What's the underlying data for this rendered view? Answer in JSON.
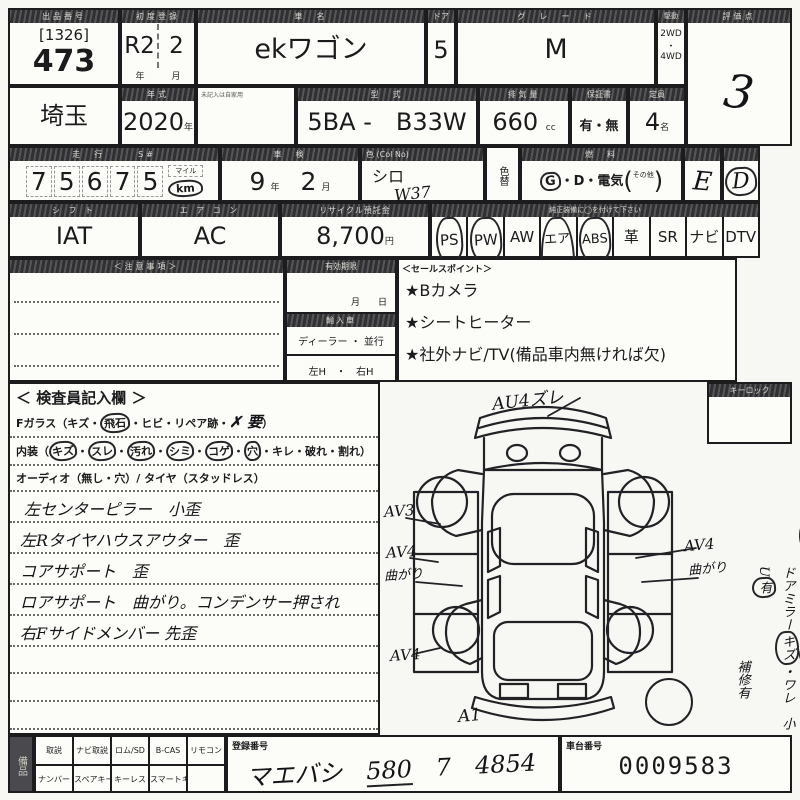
{
  "colors": {
    "paper": "#f7f7f3",
    "ink": "#1c1c1e",
    "band": "#3a3a3e"
  },
  "row1": {
    "lot_label": "出品番号",
    "lot_code": "[1326]",
    "lot_number": "473",
    "firstreg_label": "初度登録",
    "firstreg_year": "R2",
    "firstreg_month": "2",
    "unit_year": "年",
    "unit_month": "月",
    "name_label": "車　名",
    "car_name": "ekワゴン",
    "door_label": "ドア",
    "doors": "5",
    "grade_label": "グ　レ　ー　ド",
    "grade": "M",
    "drive_label": "駆動",
    "drive_2wd": "2WD",
    "drive_dot": "・",
    "drive_4wd": "4WD",
    "score_label": "評価点",
    "score": "3"
  },
  "row2": {
    "region": "埼玉",
    "year_label": "年式",
    "year": "2020",
    "unit_year": "年",
    "blank_label": "未記入は自家用",
    "model_label": "型　式",
    "model_prefix": "5BA -",
    "model": "B33W",
    "disp_label": "排気量",
    "displacement": "660",
    "unit_cc": "cc",
    "warranty_label": "保証書",
    "warranty": "有・無",
    "capacity_label": "定員",
    "capacity": "4",
    "unit_persons": "名"
  },
  "row3": {
    "mileage_label": "走　行",
    "s_label": "S#",
    "mileage_digits": [
      "7",
      "5",
      "6",
      "7",
      "5"
    ],
    "mileage_unit_top": "マイル",
    "mileage_unit": "km",
    "shaken_label": "車　検",
    "shaken_year": "9",
    "shaken_month": "2",
    "unit_year": "年",
    "unit_month": "月",
    "color_label": "色 (Col No)",
    "color": "シロ",
    "color_code": "W37",
    "colorchange_label": "色替",
    "fuel_label": "燃　料",
    "fuel_g": "G",
    "fuel_rest": "・D・電気",
    "fuel_open": "(",
    "fuel_other": "その他",
    "fuel_close": ")",
    "ext_grade": "E",
    "int_grade": "D"
  },
  "row4": {
    "shift_label": "シ フ ト",
    "shift": "IAT",
    "ac_label": "エ ア コ ン",
    "ac": "AC",
    "recycle_label": "リサイクル預託金",
    "recycle_fee": "8,700",
    "unit_yen": "円",
    "equip_label": "純正装備に◯を付けて下さい",
    "equip_last_label": "Mナビ",
    "equipment": [
      {
        "label": "PS",
        "circled": true
      },
      {
        "label": "PW",
        "circled": true
      },
      {
        "label": "AW",
        "circled": false
      },
      {
        "label": "エアB",
        "circled": true
      },
      {
        "label": "ABS",
        "circled": true
      },
      {
        "label": "革",
        "circled": false
      },
      {
        "label": "SR",
        "circled": false
      },
      {
        "label": "ナビ",
        "circled": false
      },
      {
        "label": "DTV",
        "circled": false
      }
    ]
  },
  "row5": {
    "notes_label": "＜注意事項＞",
    "validity_label": "有効期限",
    "validity_month": "月",
    "validity_day": "日",
    "import_label": "輸入車",
    "import_dealer": "ディーラー ・ 並行",
    "import_handle": "左H　・　右H",
    "sales_label": "＜セールスポイント＞",
    "sales_points": [
      "★Bカメラ",
      "★シートヒーター",
      "★社外ナビ/TV(備品車内無ければ欠)"
    ]
  },
  "inspector": {
    "title": "＜ 検査員記入欄 ＞",
    "dot": "・",
    "fglass_p1": "Fガラス（キズ・",
    "fglass_c1": "飛石",
    "fglass_p2": "・ヒビ・リペア跡・",
    "fglass_x": "✗ 要",
    "fglass_p3": "）",
    "int_p1": "内装（",
    "int_c1": "キズ",
    "int_c2": "スレ",
    "int_c3": "汚れ",
    "int_c4": "シミ",
    "int_c5": "コゲ",
    "int_c6": "穴",
    "int_p2": "キレ・破れ・割れ）",
    "audio_line": "オーディオ（無し・穴）/ タイヤ（スタッドレス）",
    "notes": [
      "左センターピラー　小歪",
      "左Rタイヤハウスアウター　歪",
      "コアサポート　歪",
      "ロアサポート　曲がり。コンデンサー押され",
      "右Fサイドメンバー 先歪"
    ],
    "bottom_note": "シート シミ大　、車内ヤニ 汚れ、臭ゞ"
  },
  "diagram": {
    "top": "AU4ズレ",
    "left1": "AV3",
    "left2": "AV4",
    "left2b": "曲がり",
    "left3": "AV4",
    "right1": "AV4",
    "right1b": "曲がり",
    "bottom": "A1"
  },
  "right_col": {
    "keylock_label": "キーロック",
    "l1a": "ホイル・CP",
    "l1b": "キズ",
    "l1c": "・ワレ",
    "l1d": "　小キズ",
    "l1e": "有",
    "l2a": "ドアミラー",
    "l2b": "キズ",
    "l2c": "・ワレ",
    "l2d": "　小U",
    "l2e": "有",
    "l3": "補修有"
  },
  "bottom": {
    "stamp": "備品",
    "grid_row1": [
      "取説",
      "ナビ取説",
      "ロム/SD",
      "B-CAS",
      "リモコン"
    ],
    "grid_row2": [
      "ナンバー",
      "スペアキー",
      "キーレス",
      "スマートキー",
      ""
    ],
    "regno_label": "登録番号",
    "regno_a": "マエバシ",
    "regno_b": "580",
    "regno_c": "7",
    "regno_d": "4854",
    "chassis_label": "車台番号",
    "chassis": "0009583"
  }
}
